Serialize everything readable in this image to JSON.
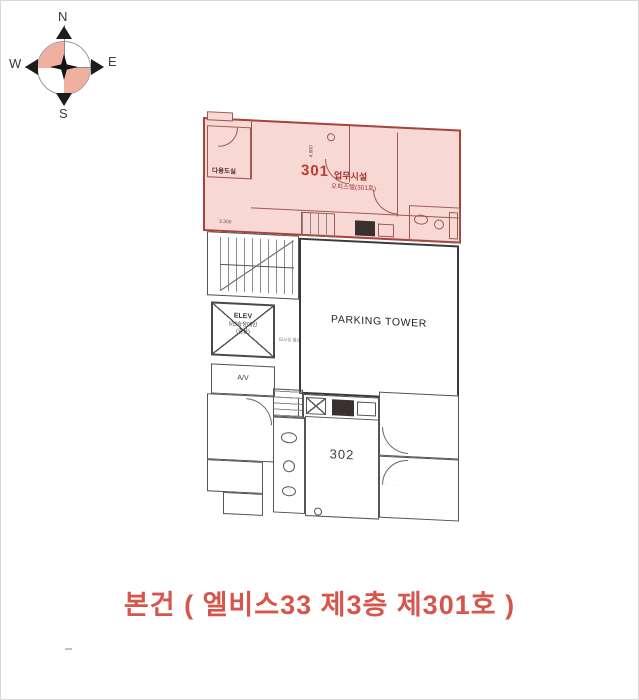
{
  "compass": {
    "n": "N",
    "e": "E",
    "s": "S",
    "w": "W"
  },
  "floor_plan": {
    "unit_301": {
      "number": "301",
      "use_label": "업무시설",
      "sub_label": "오피스텔(301호)",
      "utility_room_label": "다용도실",
      "dim_width": "3.300",
      "dim_height": "4.800"
    },
    "parking_tower_label": "PARKING TOWER",
    "elevator": {
      "title": "ELEV",
      "line2": "5인승장애인",
      "line3": "(겸용)",
      "note": "ELV실 별관승강기"
    },
    "av_room_label": "A/V",
    "unit_302": {
      "number": "302"
    }
  },
  "caption": "본건 ( 엘비스33 제3층 제301호 )",
  "colors": {
    "highlight_fill": "#f7d8d5",
    "highlight_line": "#a8423a",
    "accent_text": "#c0392b",
    "caption_text": "#d6554c",
    "plan_line": "#555555",
    "compass_quadrant": "#f0b0a0"
  }
}
